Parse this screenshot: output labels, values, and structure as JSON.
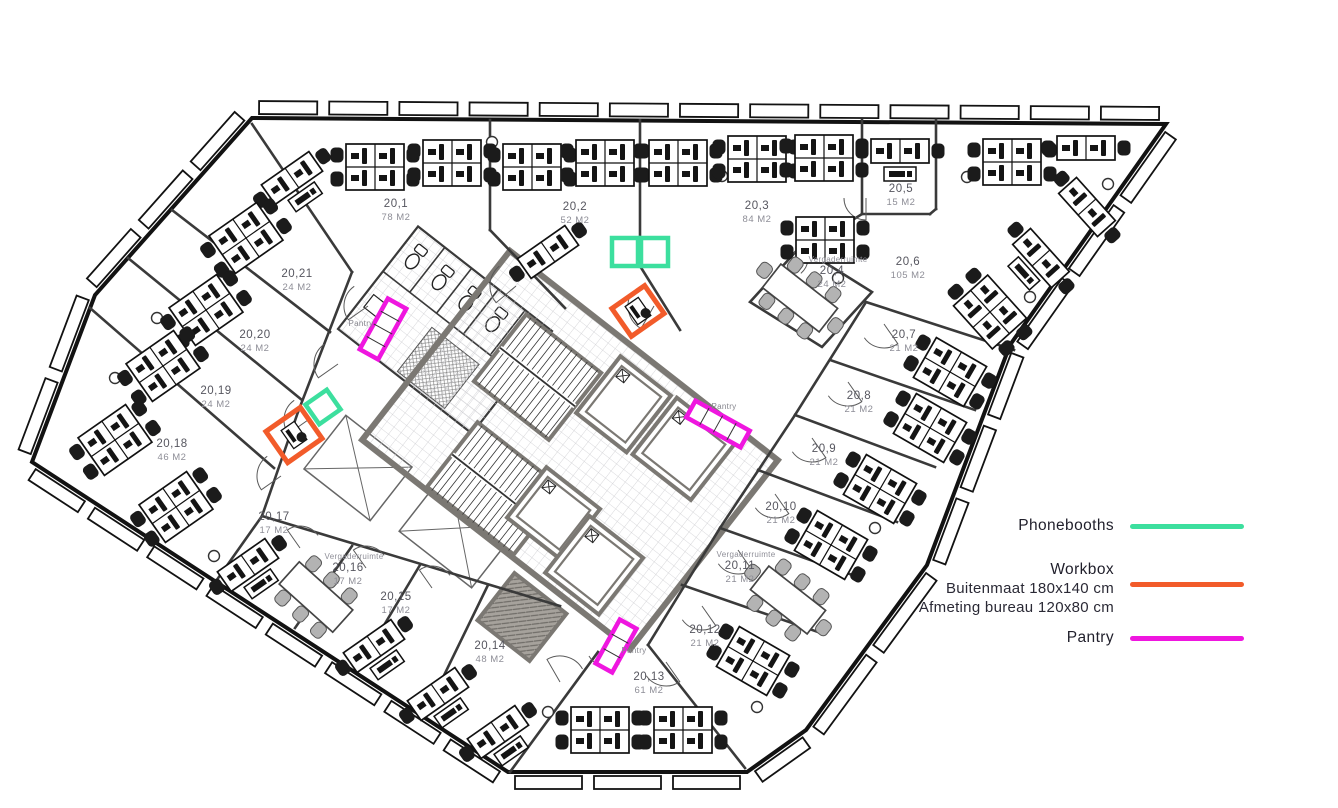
{
  "legend": {
    "items": [
      {
        "id": "phonebooths",
        "label": "Phonebooths",
        "color": "#3cdf9e",
        "sublabels": []
      },
      {
        "id": "workbox",
        "label": "Workbox",
        "color": "#f25b2a",
        "sublabels": [
          "Buitenmaat 180x140 cm",
          "Afmeting bureau 120x80 cm"
        ]
      },
      {
        "id": "pantry",
        "label": "Pantry",
        "color": "#ef16df",
        "sublabels": []
      }
    ]
  },
  "rooms": [
    {
      "id": "20-1",
      "number": "20,1",
      "area": "78 M2",
      "x": 396,
      "y": 207
    },
    {
      "id": "20-2",
      "number": "20,2",
      "area": "52 M2",
      "x": 575,
      "y": 210
    },
    {
      "id": "20-3",
      "number": "20,3",
      "area": "84 M2",
      "x": 757,
      "y": 209
    },
    {
      "id": "20-4",
      "number": "20,4",
      "area": "24 M2",
      "prefix": "Vergaderruimte",
      "x": 832,
      "y": 274
    },
    {
      "id": "20-5",
      "number": "20,5",
      "area": "15 M2",
      "x": 901,
      "y": 192
    },
    {
      "id": "20-6",
      "number": "20,6",
      "area": "105 M2",
      "x": 908,
      "y": 265
    },
    {
      "id": "20-7",
      "number": "20,7",
      "area": "21 M2",
      "x": 904,
      "y": 338
    },
    {
      "id": "20-8",
      "number": "20,8",
      "area": "21 M2",
      "x": 859,
      "y": 399
    },
    {
      "id": "20-9",
      "number": "20,9",
      "area": "21 M2",
      "x": 824,
      "y": 452
    },
    {
      "id": "20-10",
      "number": "20,10",
      "area": "21 M2",
      "x": 781,
      "y": 510
    },
    {
      "id": "20-11",
      "number": "20,11",
      "area": "21 M2",
      "prefix": "Vergaderruimte",
      "x": 740,
      "y": 569
    },
    {
      "id": "20-12",
      "number": "20,12",
      "area": "21 M2",
      "x": 705,
      "y": 633
    },
    {
      "id": "20-13",
      "number": "20,13",
      "area": "61 M2",
      "x": 649,
      "y": 680
    },
    {
      "id": "20-14",
      "number": "20,14",
      "area": "48 M2",
      "x": 490,
      "y": 649
    },
    {
      "id": "20-15",
      "number": "20,15",
      "area": "17 M2",
      "x": 396,
      "y": 600
    },
    {
      "id": "20-16",
      "number": "20,16",
      "area": "17 M2",
      "prefix": "Vergaderruimte",
      "x": 348,
      "y": 571
    },
    {
      "id": "20-17",
      "number": "20,17",
      "area": "17 M2",
      "x": 274,
      "y": 520
    },
    {
      "id": "20-18",
      "number": "20,18",
      "area": "46 M2",
      "x": 172,
      "y": 447
    },
    {
      "id": "20-19",
      "number": "20,19",
      "area": "24 M2",
      "x": 216,
      "y": 394
    },
    {
      "id": "20-20",
      "number": "20,20",
      "area": "24 M2",
      "x": 255,
      "y": 338
    },
    {
      "id": "20-21",
      "number": "20,21",
      "area": "24 M2",
      "x": 297,
      "y": 277
    }
  ],
  "pantry_labels": [
    {
      "text": "Pantry",
      "x": 361,
      "y": 326
    },
    {
      "text": "Pantry",
      "x": 724,
      "y": 409
    },
    {
      "text": "Pantry",
      "x": 634,
      "y": 653
    }
  ],
  "colors": {
    "phonebooth": "#3cdf9e",
    "workbox": "#f25b2a",
    "pantry": "#ef16df",
    "wall": "#3a3a3a",
    "core_wall": "#7b7873",
    "label_number": "#56565f",
    "label_area": "#8e8e97",
    "legend_text": "#201f2b"
  }
}
